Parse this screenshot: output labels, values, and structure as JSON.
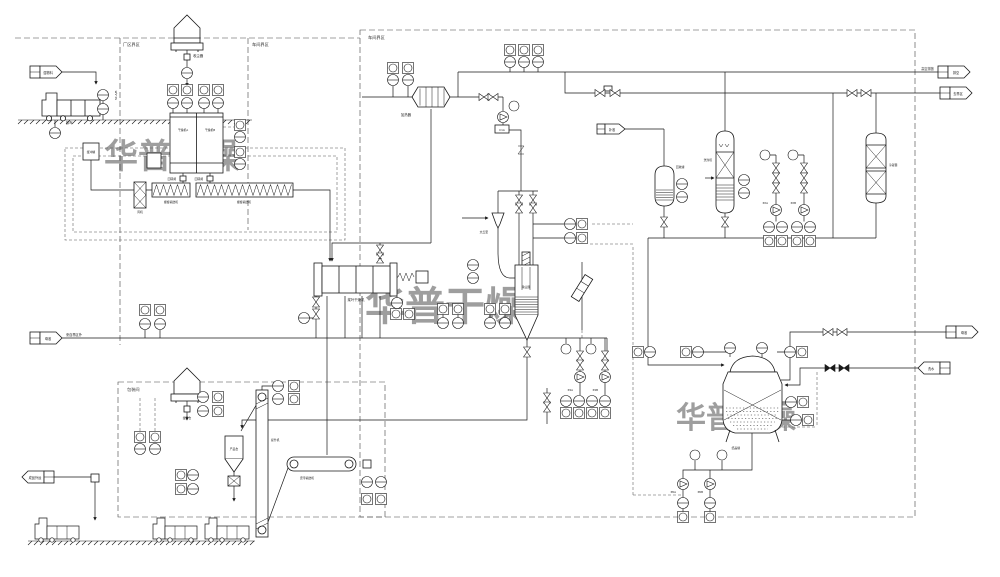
{
  "watermark": {
    "text": "华普干燥",
    "color": "#c86a55"
  },
  "boundaries": {
    "plant": "厂区界区",
    "workshop": "车间界区",
    "battery": "车间界区",
    "packing": "包装间"
  },
  "flags": {
    "wet_feed": {
      "label": "湿物料"
    },
    "liquor_feed": {
      "label": "母液",
      "note": "来自界区外"
    },
    "product_ship": {
      "label": "成品外运"
    },
    "vent": {
      "label": "排空",
      "note": "高空排放"
    },
    "to_battery": {
      "label": "去界区"
    },
    "liquor_out": {
      "label": "母液"
    },
    "wash_water": {
      "label": "洗水"
    },
    "makeup": {
      "label": "补液"
    }
  },
  "equipment": {
    "unload_truck": "卸车",
    "dust_collector_top": "收尘器",
    "buffer_tank": "缓冲罐",
    "dryer_a": "干燥机A",
    "dryer_b": "干燥机B",
    "rotary_valve_a": "回转阀",
    "rotary_valve_b": "回转阀",
    "screw_conveyor_1": "螺旋输送机",
    "screw_conveyor_2": "螺旋输送机",
    "fan": "风机",
    "paddle_dryer": "桨叶干燥机",
    "air_heater": "加热器",
    "blower": "C1A",
    "venturi": "文丘里",
    "bag_filter": "除尘器",
    "buffer_silo": "缓存仓",
    "product_bin": "产品仓",
    "bucket_elevator": "提升机",
    "belt_conveyor": "皮带输送机",
    "recovery_tank": "回收罐",
    "scrubber": "洗涤塔",
    "condenser": "冷凝器",
    "crystallizer": "结晶罐",
    "pump_p4a": "P4A",
    "pump_p4b": "P4B",
    "pump_p6a": "P6A",
    "pump_p6b": "P6B",
    "pump_p2a": "P2A",
    "pump_p2b": "P2B",
    "riser_tag": "SC-A/B"
  }
}
